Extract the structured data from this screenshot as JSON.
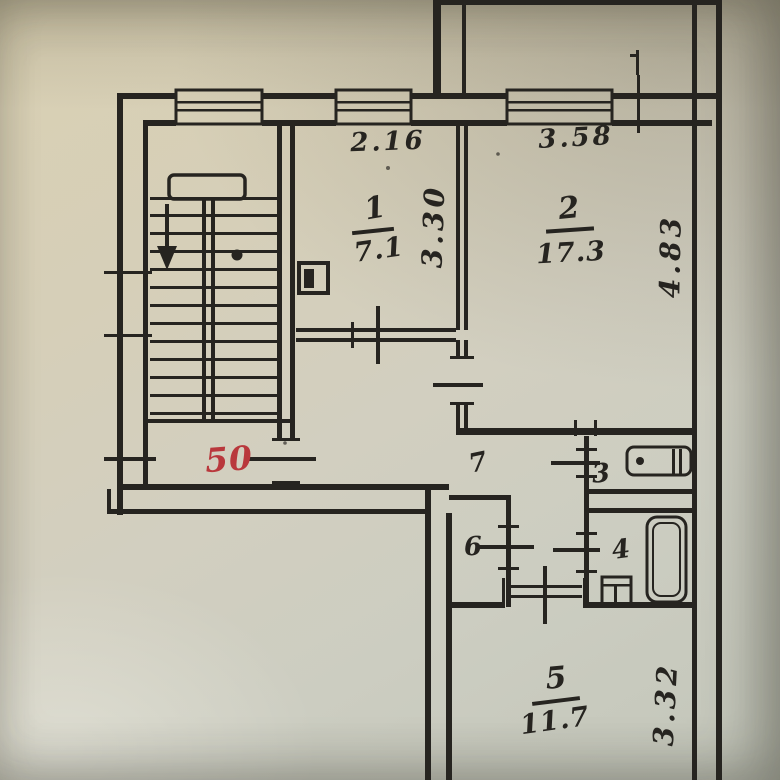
{
  "plan": {
    "apartment_number": "50",
    "rooms": {
      "room1": {
        "number": "1",
        "area": "7.1"
      },
      "room2": {
        "number": "2",
        "area": "17.3"
      },
      "room5": {
        "number": "5",
        "area": "11.7"
      },
      "hall": {
        "number": "7"
      },
      "toilet": {
        "number": "3"
      },
      "bath": {
        "number": "4"
      },
      "closet": {
        "number": "6"
      }
    },
    "dimensions": {
      "room1_width": "2.16",
      "room1_depth": "3.30",
      "room2_width": "3.58",
      "room2_depth": "4.83",
      "room5_depth": "3.32"
    },
    "fixtures": [
      "staircase",
      "bathtub",
      "toilet-bowl",
      "sink",
      "windows"
    ],
    "colors": {
      "ink": "#262420",
      "apartment_number_red": "#b9383c",
      "paper": "#d2ccba"
    }
  }
}
